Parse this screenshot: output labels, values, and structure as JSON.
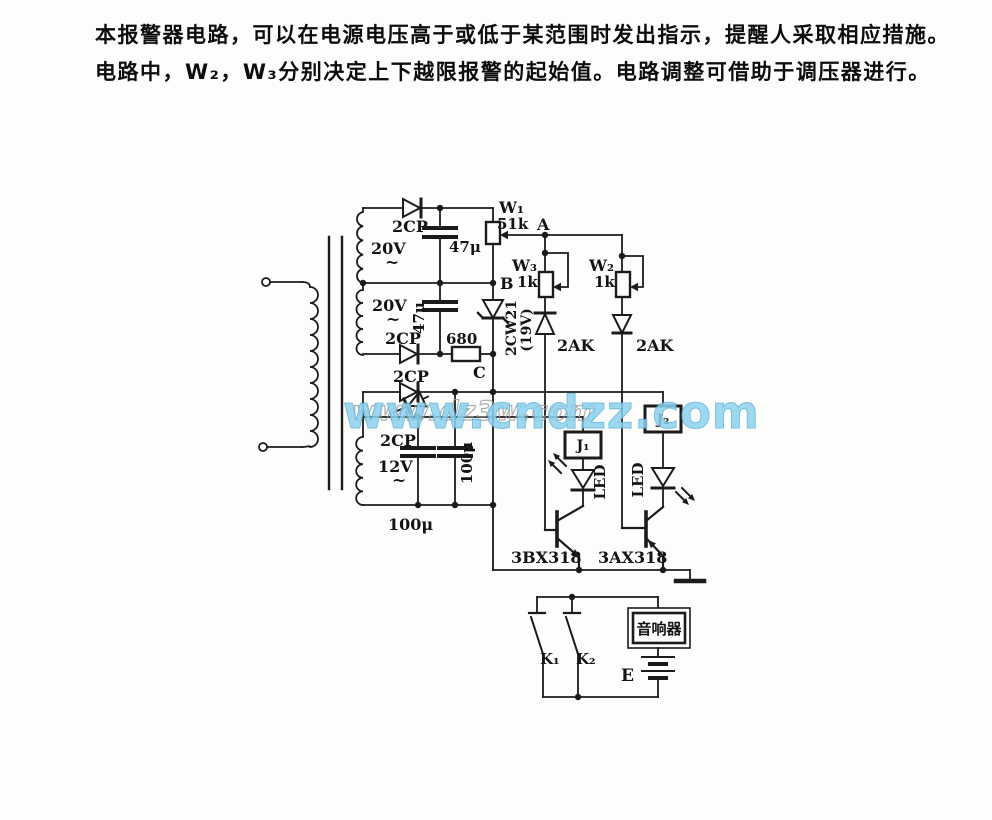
{
  "description": {
    "line1": "本报警器电路，可以在电源电压高于或低于某范围时发出指示，提醒人采取相应措施。",
    "line2": "电路中，W₂，W₃分别决定上下越限报警的起始值。电路调整可借助于调压器进行。"
  },
  "watermarks": {
    "primary": "www.cndzz.com",
    "secondary": "www.dz3w.com",
    "color": "#8ed2ee"
  },
  "schematic": {
    "transformer": {
      "winding_top": "20V",
      "winding_mid": "20V",
      "winding_bottom": "12V",
      "ac": "~"
    },
    "rectifier": {
      "diode_top": "2CP",
      "diode_mid": "2CP",
      "diode_low1": "2CP",
      "diode_low2": "2CP",
      "cap_top": "47μ",
      "cap_mid": "47μ",
      "cap_low1": "100μ",
      "cap_low2": "100μ",
      "resistor": "680"
    },
    "reference": {
      "pot": "W₁",
      "pot_value": "51k",
      "node_a": "A",
      "node_b": "B",
      "node_c": "C",
      "zener": "2CW21",
      "zener_voltage": "(19V)"
    },
    "comparators": {
      "pot_low": "W₃",
      "pot_low_value": "1k",
      "pot_high": "W₂",
      "pot_high_value": "1k",
      "diode_low": "2AK",
      "diode_high": "2AK"
    },
    "drivers": {
      "relay_low": "J₁",
      "relay_high": "J₂",
      "led_low": "LED",
      "led_high": "LED",
      "transistor_low": "3BX318",
      "transistor_high": "3AX318"
    },
    "alarm": {
      "switch1": "K₁",
      "switch2": "K₂",
      "sounder": "音响器",
      "battery": "E"
    }
  }
}
